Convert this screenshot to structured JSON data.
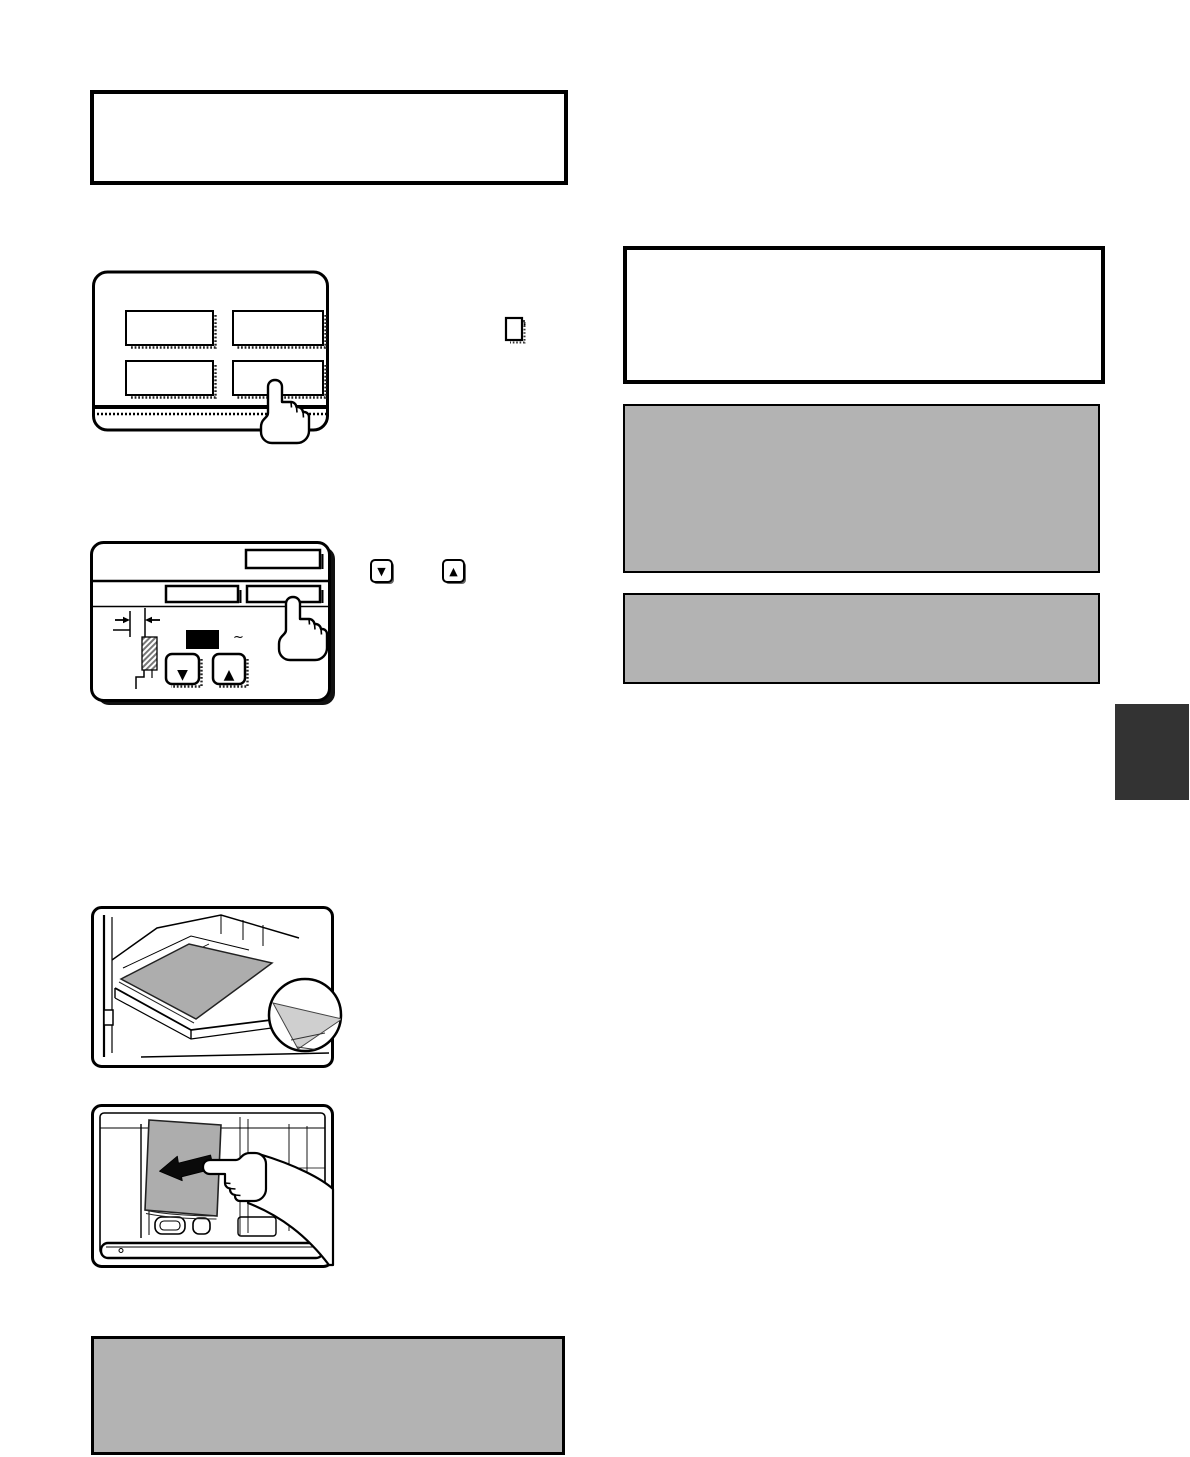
{
  "page": {
    "width": 1190,
    "height": 1457,
    "background": "#ffffff"
  },
  "colors": {
    "page-bg": "#ffffff",
    "line": "#000000",
    "gray-panel": "#b3b3b3",
    "paper-gray": "#adadad",
    "inset-gray": "#cfcfcf",
    "side-tab": "#333333",
    "shadow-dot": "#333333"
  },
  "glyphs": {
    "down_arrow": "▼",
    "up_arrow": "▲",
    "tilde": "~"
  },
  "icons": {
    "pointing_hand": "pressing-finger-icon",
    "down_arrow_key": "down-arrow-icon",
    "up_arrow_key": "up-arrow-icon",
    "document_key": "touch-key-icon",
    "left_arrow": "left-arrow-icon",
    "magnifier_inset": "zoom-circle-inset"
  }
}
